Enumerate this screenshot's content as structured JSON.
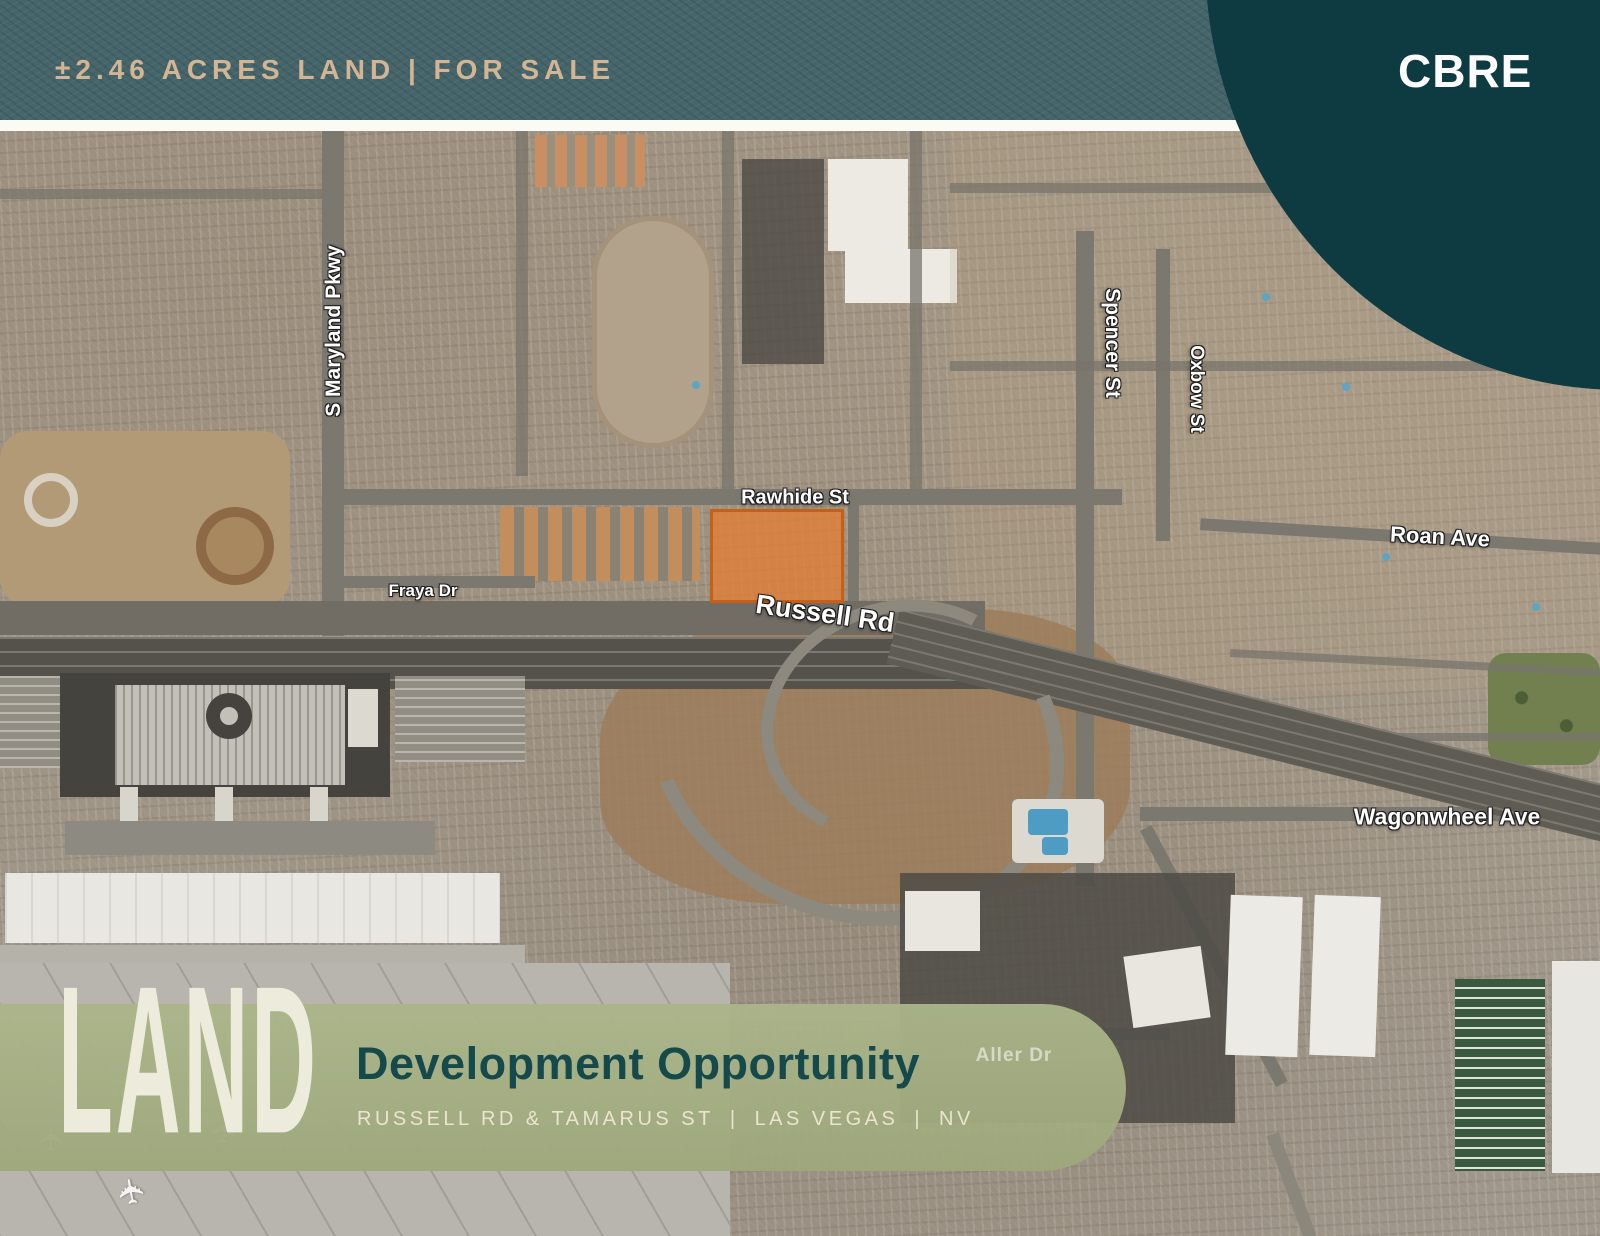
{
  "header": {
    "sale_title": "±2.46 ACRES LAND | FOR SALE",
    "brand_logo": "CBRE"
  },
  "map": {
    "street_labels": [
      {
        "name": "s-maryland-pkwy",
        "text": "S Maryland Pkwy"
      },
      {
        "name": "rawhide-st",
        "text": "Rawhide St"
      },
      {
        "name": "spencer-st",
        "text": "Spencer St"
      },
      {
        "name": "oxbow-st",
        "text": "Oxbow St"
      },
      {
        "name": "roan-ave",
        "text": "Roan Ave"
      },
      {
        "name": "fraya-dr",
        "text": "Fraya Dr"
      },
      {
        "name": "russell-rd",
        "text": "Russell Rd"
      },
      {
        "name": "wagonwheel-ave",
        "text": "Wagonwheel Ave"
      },
      {
        "name": "aller-dr",
        "text": "Aller Dr"
      }
    ],
    "highlight_parcel": {
      "fill": "#E07D34",
      "border": "#C85F17"
    }
  },
  "footer": {
    "logo_text": "LAND",
    "title": "Development Opportunity",
    "location_parts": [
      "RUSSELL RD & TAMARUS ST",
      "LAS VEGAS",
      "NV"
    ],
    "divider": "|"
  },
  "icons": {
    "aircraft": "✈"
  },
  "colors": {
    "header_teal": "#45656B",
    "brand_teal": "#0D3B41",
    "band_sage": "#A7B184",
    "title_green": "#15494B",
    "header_text_tan": "#D3B493",
    "cream_logo": "#EDEBDC"
  }
}
